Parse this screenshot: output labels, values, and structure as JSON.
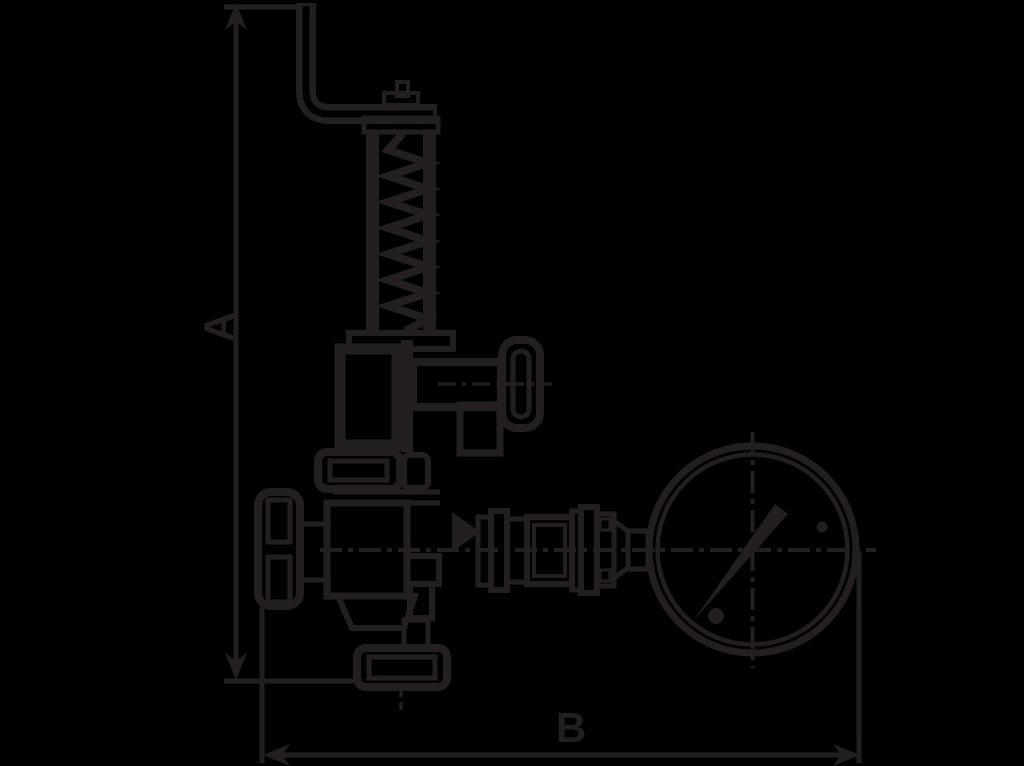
{
  "figure": {
    "type": "technical-line-drawing",
    "description": "Dimensional outline drawing of a spring-loaded regulator valve with lever, handwheel and pressure gauge",
    "background_color": "#000000",
    "line_color": "#231f20",
    "dimensions": {
      "vertical_label": "A",
      "horizontal_label": "B"
    },
    "parts": [
      "lever-handle",
      "adjusting-screw",
      "spring-housing",
      "spring-coil",
      "side-knob",
      "bonnet-flange",
      "handwheel",
      "valve-body",
      "outlet-union",
      "gauge-piping",
      "pressure-gauge",
      "gauge-needle"
    ]
  }
}
